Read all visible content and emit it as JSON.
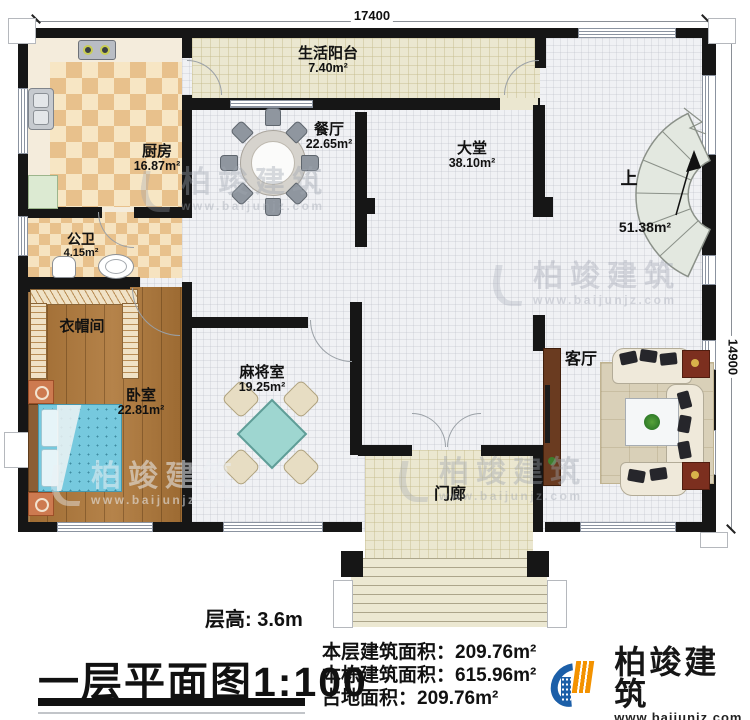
{
  "plan": {
    "dimension_top": "17400",
    "dimension_right": "14900",
    "rooms": [
      {
        "name": "生活阳台",
        "area": "7.40m²"
      },
      {
        "name": "厨房",
        "area": "16.87m²"
      },
      {
        "name": "餐厅",
        "area": "22.65m²"
      },
      {
        "name": "大堂",
        "area": "38.10m²"
      },
      {
        "name": "公卫",
        "area": "4.15m²"
      },
      {
        "name": "衣帽间",
        "area": ""
      },
      {
        "name": "卧室",
        "area": "22.81m²"
      },
      {
        "name": "麻将室",
        "area": "19.25m²"
      },
      {
        "name": "上",
        "area": "51.38m²"
      },
      {
        "name": "客厅",
        "area": ""
      },
      {
        "name": "门廊",
        "area": ""
      }
    ]
  },
  "footer": {
    "floor_height": "层高: 3.6m",
    "title": "一层平面图",
    "scale": "1:100",
    "stats": [
      {
        "label": "本层建筑面积：",
        "value": "209.76m²"
      },
      {
        "label": "本栋建筑面积：",
        "value": "615.96m²"
      },
      {
        "label": "占地面积：",
        "value": "209.76m²"
      }
    ]
  },
  "brand": {
    "name": "柏竣建筑",
    "url": "www.baijunjz.com"
  },
  "watermark": {
    "name": "柏竣建筑",
    "url": "www.baijunjz.com"
  }
}
